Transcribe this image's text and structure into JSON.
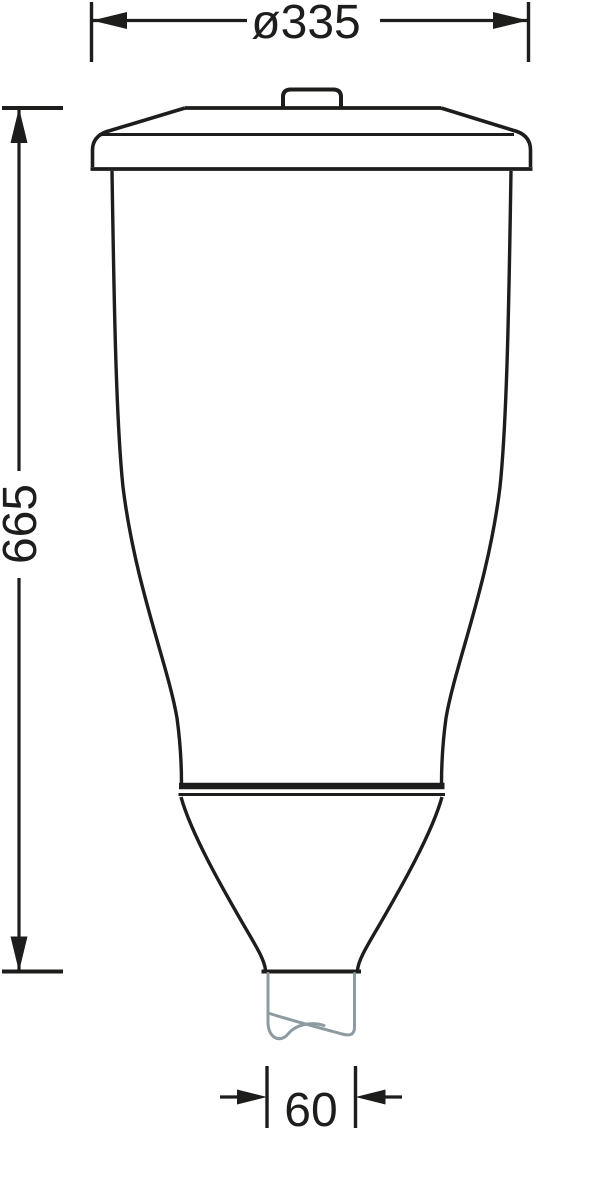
{
  "page": {
    "background_color": "#ffffff"
  },
  "drawing": {
    "type": "technical-dimension-drawing",
    "subject": "post-top luminaire side elevation",
    "line_color": "#1d1d1b",
    "spigot_color": "#8d9ba1",
    "dimensions": {
      "diameter": "ø335",
      "height": "665",
      "spigot_width": "60"
    }
  }
}
